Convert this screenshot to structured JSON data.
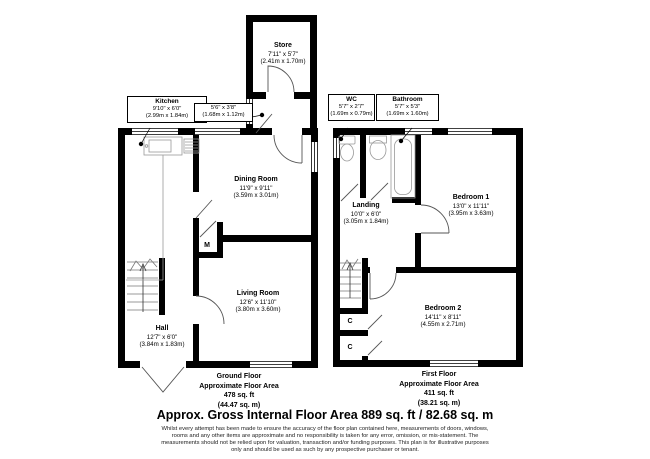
{
  "title": "Approx. Gross Internal Floor Area 889 sq. ft / 82.68 sq. m",
  "disclaimer": [
    "Whilst every attempt has been made to ensure the accuracy of the floor plan contained here, measurements of doors, windows,",
    "rooms and any other items are approximate and no responsibility is taken for any error, omission, or mis-statement. The",
    "measurements should not be relied upon for valuation, transaction and/or funding purposes. This plan is for illustrative purposes",
    "only and should be used as such by any prospective purchaser or tenant."
  ],
  "rooms": {
    "store": {
      "name": "Store",
      "imperial": "7'11\" x 5'7\"",
      "metric": "(2.41m x 1.70m)"
    },
    "kitchen": {
      "name": "Kitchen",
      "imperial": "9'10\" x 6'0\"",
      "metric": "(2.99m x 1.84m)"
    },
    "lobby": {
      "imperial": "5'6\" x 3'8\"",
      "metric": "(1.68m x 1.12m)"
    },
    "wc": {
      "name": "WC",
      "imperial": "5'7\" x 2'7\"",
      "metric": "(1.69m x 0.79m)"
    },
    "bathroom": {
      "name": "Bathroom",
      "imperial": "5'7\" x 5'3\"",
      "metric": "(1.69m x 1.60m)"
    },
    "dining": {
      "name": "Dining Room",
      "imperial": "11'9\" x 9'11\"",
      "metric": "(3.59m x 3.01m)"
    },
    "landing": {
      "name": "Landing",
      "imperial": "10'0\" x 6'0\"",
      "metric": "(3.05m x 1.84m)"
    },
    "bedroom1": {
      "name": "Bedroom 1",
      "imperial": "13'0\" x 11'11\"",
      "metric": "(3.95m x 3.63m)"
    },
    "living": {
      "name": "Living Room",
      "imperial": "12'6\" x 11'10\"",
      "metric": "(3.80m x 3.60m)"
    },
    "hall": {
      "name": "Hall",
      "imperial": "12'7\" x 6'0\"",
      "metric": "(3.84m x 1.83m)"
    },
    "bedroom2": {
      "name": "Bedroom 2",
      "imperial": "14'11\" x 8'11\"",
      "metric": "(4.55m x 2.71m)"
    }
  },
  "cupboards": {
    "meter": "M",
    "c1": "C",
    "c2": "C"
  },
  "floors": {
    "ground": {
      "name": "Ground Floor",
      "line2": "Approximate Floor Area",
      "area_ft": "478 sq. ft",
      "area_m": "(44.47 sq. m)"
    },
    "first": {
      "name": "First Floor",
      "line2": "Approximate Floor Area",
      "area_ft": "411 sq. ft",
      "area_m": "(38.21 sq. m)"
    }
  },
  "colors": {
    "wall": "#000000",
    "fixture": "#999999",
    "background": "#ffffff"
  }
}
